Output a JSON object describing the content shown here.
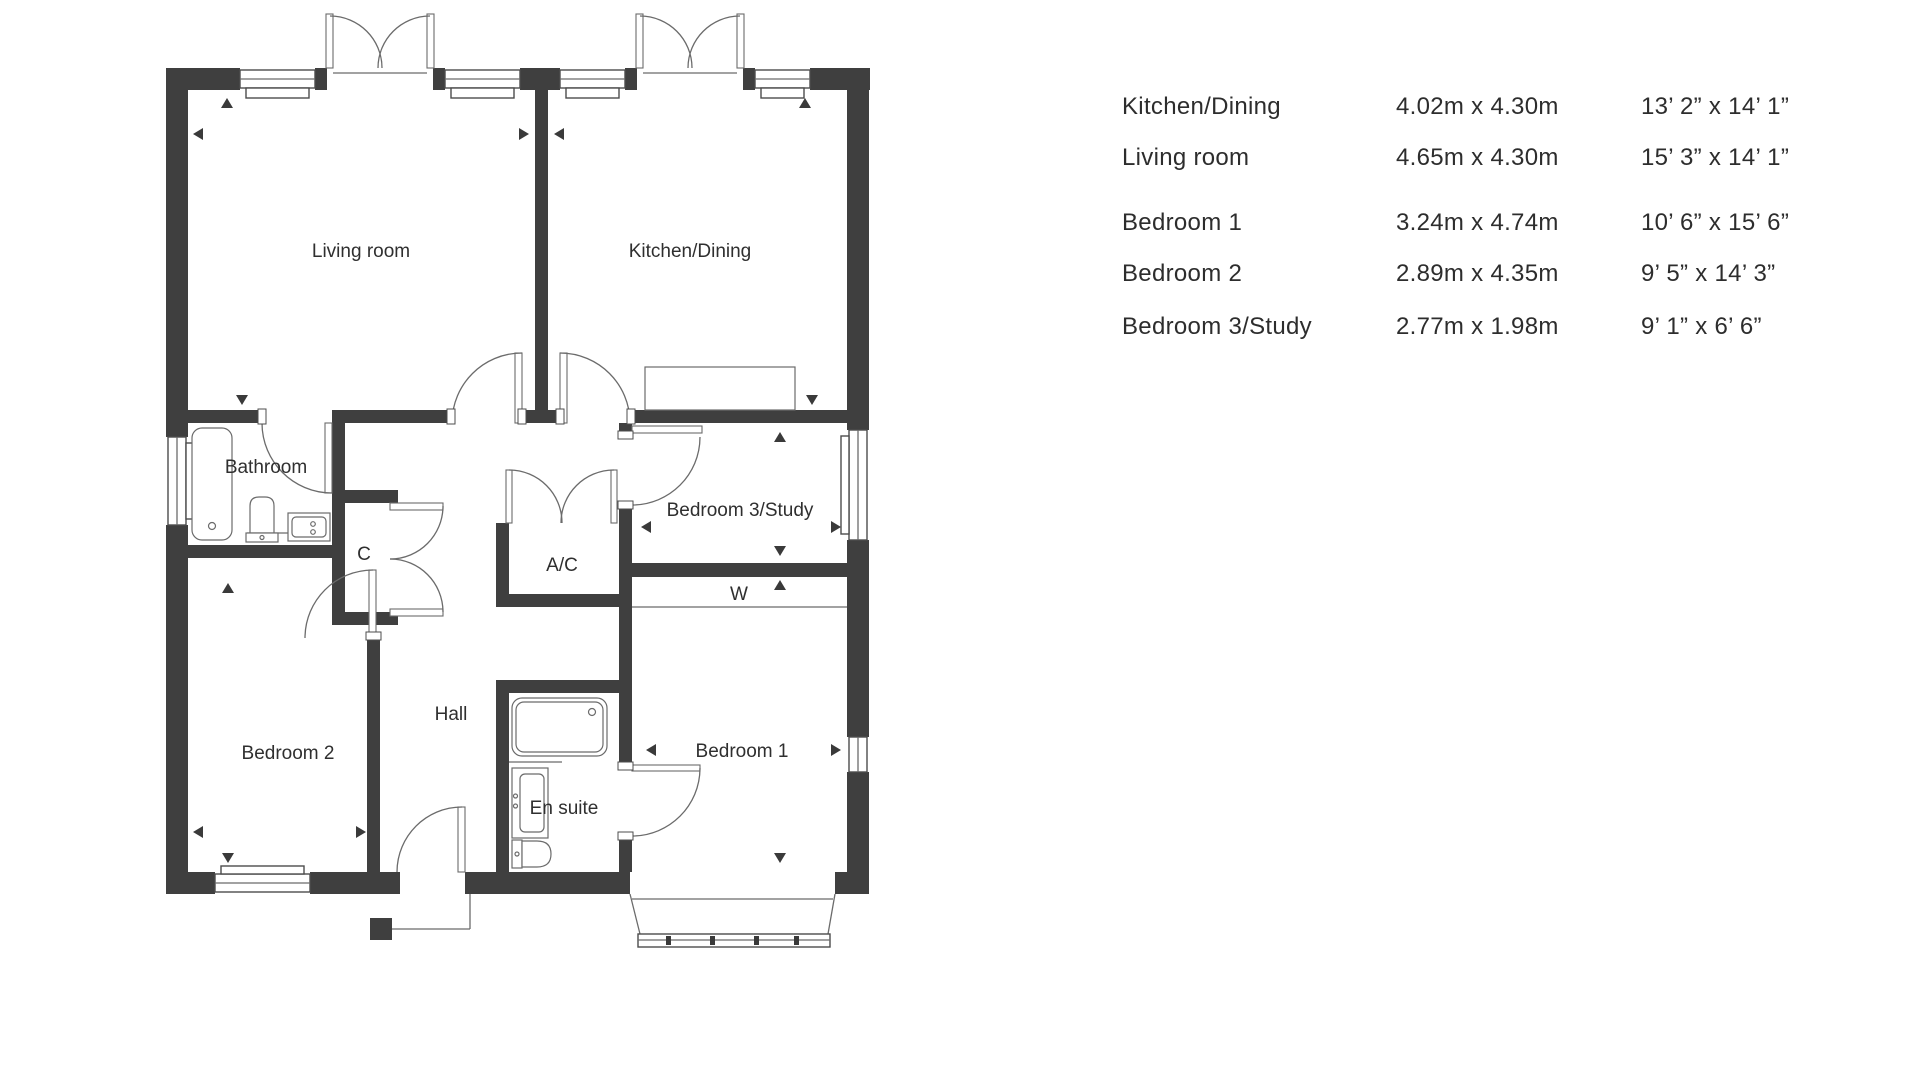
{
  "colors": {
    "wall": "#3f3f3f",
    "plan_line": "#6b6b6b",
    "label_text": "#2f2f2f",
    "table_text": "#2d2d2d",
    "background": "#ffffff"
  },
  "floor_plan": {
    "labels": {
      "living_room": "Living room",
      "kitchen_dining": "Kitchen/Dining",
      "bathroom": "Bathroom",
      "bedroom3_study": "Bedroom 3/Study",
      "closet": "C",
      "airing_cupboard": "A/C",
      "wardrobe": "W",
      "hall": "Hall",
      "bedroom2": "Bedroom 2",
      "en_suite": "En suite",
      "bedroom1": "Bedroom 1"
    }
  },
  "dimensions_table": {
    "rows": [
      {
        "name": "Kitchen/Dining",
        "metric": "4.02m x 4.30m",
        "imperial": "13’ 2” x 14’ 1”"
      },
      {
        "name": "Living room",
        "metric": "4.65m x 4.30m",
        "imperial": "15’ 3” x 14’ 1”"
      },
      {
        "name": "Bedroom 1",
        "metric": "3.24m x 4.74m",
        "imperial": "10’ 6” x 15’ 6”"
      },
      {
        "name": "Bedroom 2",
        "metric": "2.89m x 4.35m",
        "imperial": "9’ 5” x 14’ 3”"
      },
      {
        "name": "Bedroom 3/Study",
        "metric": "2.77m x 1.98m",
        "imperial": "9’ 1” x 6’ 6”"
      }
    ]
  }
}
